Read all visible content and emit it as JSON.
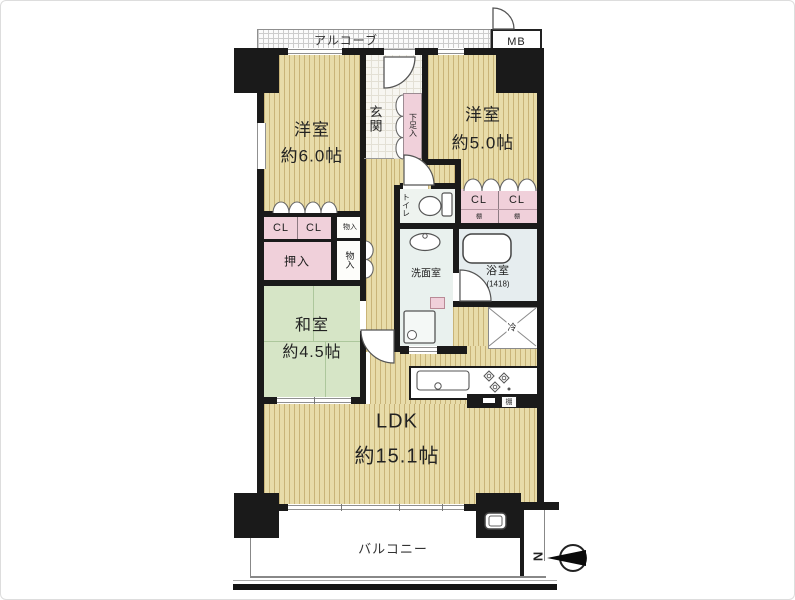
{
  "rooms": {
    "alcove": {
      "label": "アルコーブ"
    },
    "meter_box": {
      "label": "MB"
    },
    "western_room_1": {
      "label": "洋室",
      "size": "約6.0帖"
    },
    "western_room_2": {
      "label": "洋室",
      "size": "約5.0帖"
    },
    "entrance": {
      "label": "玄関"
    },
    "shoe_cabinet": {
      "label": "下足入"
    },
    "toilet": {
      "label": "トイレ"
    },
    "washroom": {
      "label": "洗面室"
    },
    "bathroom": {
      "label": "浴室",
      "size": "(1418)"
    },
    "refrigerator_space": {
      "label": "冷"
    },
    "japanese_room": {
      "label": "和室",
      "size": "約4.5帖"
    },
    "ldk": {
      "label": "LDK",
      "size": "約15.1帖"
    },
    "balcony": {
      "label": "バルコニー"
    }
  },
  "storage": {
    "closet": "CL",
    "shelf": "棚",
    "oshiire": "押入",
    "small_storage": "物入"
  },
  "compass": {
    "north": "N"
  },
  "colors": {
    "wall": "#1a1a1a",
    "wood_floor": "#e8dca9",
    "wood_stripe": "#c9b478",
    "tatami_green": "#d6e5c6",
    "closet_pink": "#f0d0da",
    "bath_blue": "#e6edef",
    "toilet_floor": "#eef3ef",
    "washroom_floor": "#e9f1ee"
  }
}
